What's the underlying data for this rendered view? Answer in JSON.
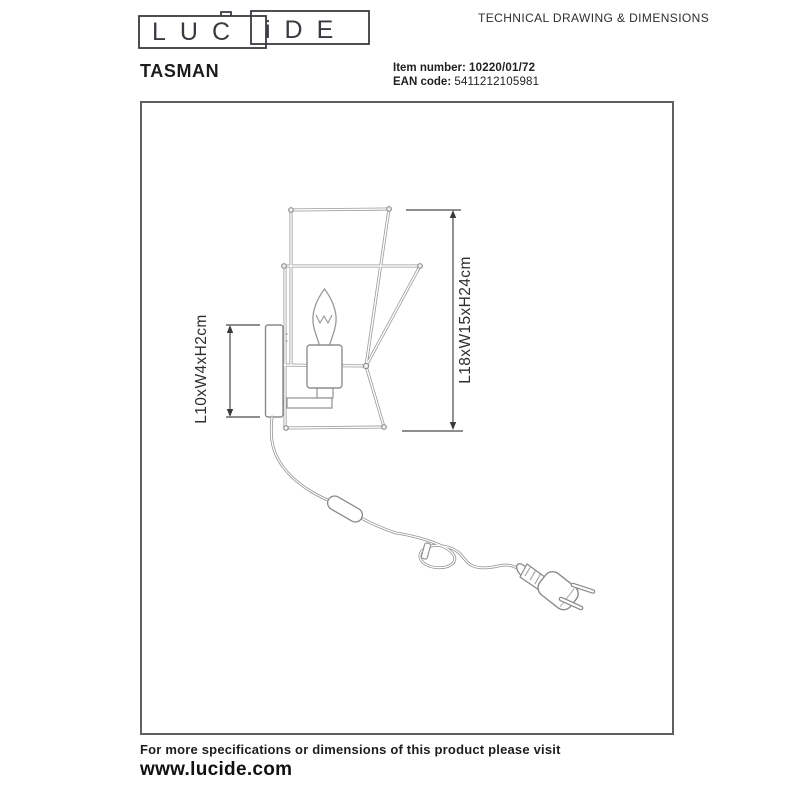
{
  "header": {
    "logo": {
      "part1": "LUC",
      "part2": "iDE"
    },
    "tagline": "TECHNICAL DRAWING & DIMENSIONS"
  },
  "product": {
    "name": "TASMAN",
    "item_number_label": "Item number:",
    "item_number": "10220/01/72",
    "ean_label": "EAN code:",
    "ean": "5411212105981"
  },
  "drawing": {
    "dim_bracket": "L10xW4xH2cm",
    "dim_overall": "L18xW15xH24cm",
    "line_color": "#9a9a9a",
    "dim_color": "#2d2d2d",
    "frame_border_color": "#5f5f5f"
  },
  "footer": {
    "line1": "For more specifications or dimensions of this product please visit",
    "line2": "www.lucide.com"
  }
}
